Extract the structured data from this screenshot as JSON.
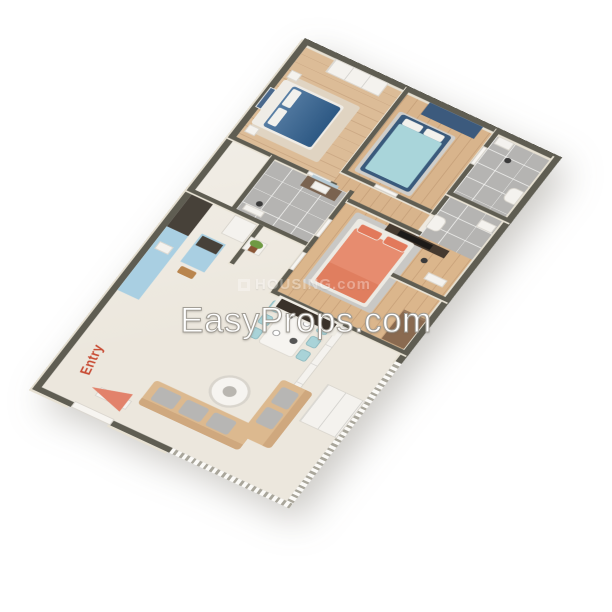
{
  "watermarks": {
    "primary": "EasyProps.com",
    "secondary": "HOUSING.com"
  },
  "entry": {
    "label": "Entry"
  },
  "palette": {
    "background": "#ffffff",
    "wall_top": "#5f5d52",
    "wall_face_cream": "#e9e3d5",
    "marble_floor": "#ece7dd",
    "wood_floor": "#dcbc97",
    "tile_floor": "#b5b4b2",
    "bed_blue": "#31608f",
    "bed_teal": "#a9d5da",
    "bed_coral": "#e78c6f",
    "wardrobe_navy": "#3c5a7d",
    "kitchen_cabinet_blue": "#a9cfe2",
    "counter_dark": "#474139",
    "sofa_tan": "#dcb98f",
    "cushion_gray": "#b7b6b4",
    "rug_gray": "#c9c8c5",
    "wood_furniture_brown": "#8a6a50",
    "tv_dark": "#3a322a",
    "entry_arrow": "#e2826b",
    "entry_text": "#c84b33",
    "watermark_white": "#ffffff"
  },
  "scene": {
    "type": "3d-floor-plan",
    "projection": "isometric",
    "rooms": [
      {
        "name": "bedroom-1",
        "floor": "wood",
        "furniture": [
          "double-bed-blue",
          "white-wardrobe",
          "nightstands",
          "wall-art",
          "rug"
        ]
      },
      {
        "name": "bedroom-2",
        "floor": "wood",
        "furniture": [
          "double-bed-teal",
          "navy-wardrobe",
          "rug"
        ]
      },
      {
        "name": "master-bedroom",
        "floor": "wood",
        "furniture": [
          "double-bed-coral",
          "tv-shelf",
          "dresser",
          "rug"
        ]
      },
      {
        "name": "bathroom-1",
        "floor": "tile",
        "furniture": [
          "vanity",
          "mirror",
          "shower"
        ]
      },
      {
        "name": "bathroom-2",
        "floor": "tile",
        "furniture": [
          "toilet",
          "sink",
          "shower",
          "bath-mat"
        ]
      },
      {
        "name": "bathroom-3",
        "floor": "tile",
        "furniture": [
          "toilet",
          "sink",
          "shower"
        ]
      },
      {
        "name": "kitchen",
        "floor": "marble",
        "furniture": [
          "counter",
          "island",
          "fridge",
          "sink",
          "cutting-board",
          "plant-shelf"
        ]
      },
      {
        "name": "living-dining",
        "floor": "marble",
        "furniture": [
          "sofa",
          "sofa",
          "coffee-table",
          "tv-console",
          "dining-table",
          "six-chairs",
          "cabinet",
          "shoe-cabinet",
          "sliding-panel"
        ]
      }
    ]
  }
}
